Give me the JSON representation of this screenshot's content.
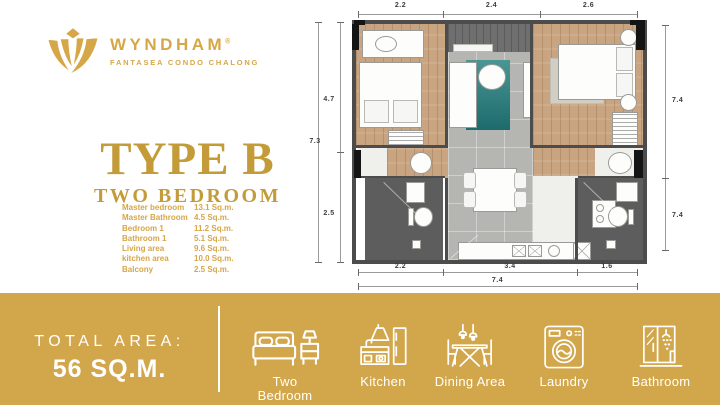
{
  "brand": {
    "name": "WYNDHAM",
    "mark": "®",
    "subtitle": "FANTASEA CONDO CHALONG"
  },
  "unit": {
    "title": "TYPE B",
    "subtitle": "TWO BEDROOM",
    "rooms": [
      {
        "label": "Master bedroom",
        "area": "13.1 Sq.m."
      },
      {
        "label": "Master Bathroom",
        "area": "4.5 Sq.m."
      },
      {
        "label": "Bedroom 1",
        "area": "11.2 Sq.m."
      },
      {
        "label": "Bathroom 1",
        "area": "5.1 Sq.m."
      },
      {
        "label": "Living area",
        "area": "9.6 Sq.m."
      },
      {
        "label": "kitchen area",
        "area": "10.0 Sq.m."
      },
      {
        "label": "Balcony",
        "area": "2.5 Sq.m."
      }
    ]
  },
  "floorplan": {
    "dims": {
      "top": [
        "2.2",
        "2.4",
        "2.6"
      ],
      "left_outer": "7.3",
      "left_inner": [
        "4.7",
        "2.5"
      ],
      "right": [
        "7.4",
        "7.4"
      ],
      "bottom": [
        "2.2",
        "3.4",
        "1.6"
      ],
      "bottom_total": "7.4"
    }
  },
  "footer": {
    "total_area_label": "TOTAL AREA:",
    "total_area_value": "56 SQ.M.",
    "features": [
      {
        "icon": "bed-icon",
        "label": "Two Bedroom"
      },
      {
        "icon": "kitchen-icon",
        "label": "Kitchen"
      },
      {
        "icon": "dining-area-icon",
        "label": "Dining Area"
      },
      {
        "icon": "washing-machine-icon",
        "label": "Laundry"
      },
      {
        "icon": "shower-icon",
        "label": "Bathroom"
      }
    ]
  },
  "colors": {
    "gold": "#D2A64B",
    "logo_gold": "#D6A747",
    "heading_gold": "#C49B39"
  }
}
